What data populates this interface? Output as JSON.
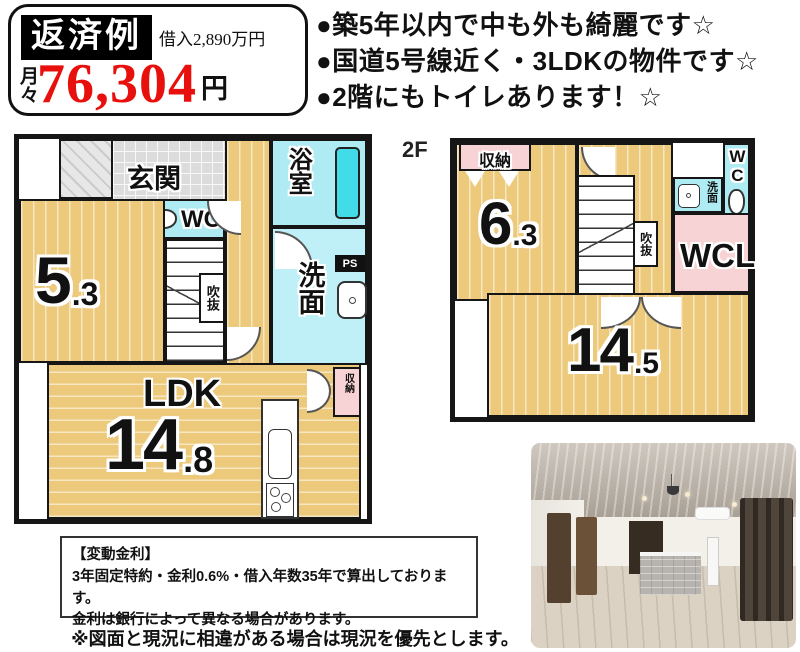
{
  "colors": {
    "accent_red": "#e8100c",
    "wall_black": "#161616",
    "room_yellow": "#ecc97b",
    "water_cyan": "#aeebf3",
    "tub_cyan": "#41dce8",
    "closet_pink": "#f8d3d6"
  },
  "repayment_box": {
    "title": "返済例",
    "loan_label": "借入2,890万円",
    "monthly_label": "月々",
    "amount": "76,304",
    "unit": "円"
  },
  "highlights": [
    "●築5年以内で中も外も綺麗です☆",
    "●国道5号線近く・3LDKの物件です☆",
    "●2階にもトイレあります！☆"
  ],
  "floor1": {
    "label": "1F",
    "genkan": "玄関",
    "bath": "浴室",
    "closet": "収納",
    "wc": "WC",
    "room_main": "5",
    "room_dec": ".3",
    "void": "吹抜",
    "ps": "PS",
    "washroom": "洗面",
    "ldk": "LDK",
    "ldk_main": "14",
    "ldk_dec": ".8",
    "ldk_closet": "収納"
  },
  "floor2": {
    "label": "2F",
    "closet": "収納",
    "room_main": "6",
    "room_dec": ".3",
    "void": "吹抜",
    "washroom": "洗面",
    "wc": "WC",
    "wcl": "WCL",
    "main_room_main": "14",
    "main_room_dec": ".5"
  },
  "footer": {
    "rate_title": "【変動金利】",
    "rate_line1": "3年固定特約・金利0.6%・借入年数35年で算出しております。",
    "rate_line2": "金利は銀行によって異なる場合があります。",
    "disclaimer": "※図面と現況に相違がある場合は現況を優先とします。"
  }
}
